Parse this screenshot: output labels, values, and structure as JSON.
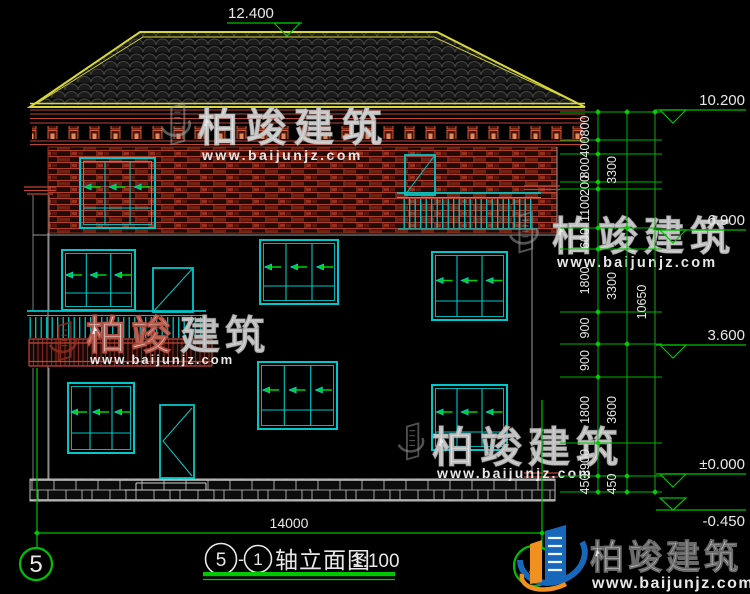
{
  "drawing": {
    "elevations": {
      "ridge": "12.400",
      "eave": "10.200",
      "floor3": "6.900",
      "floor2": "3.600",
      "ground": "±0.000",
      "base": "-0.450"
    },
    "dimensions": {
      "right_inner": [
        "800",
        "400",
        "800",
        "200",
        "1100",
        "600",
        "1800",
        "900",
        "900",
        "1800",
        "900",
        "450"
      ],
      "right_middle": [
        "3300",
        "3300",
        "3600",
        "450"
      ],
      "right_total": "10650",
      "bottom_width": "14000"
    },
    "title": {
      "axis_start": "5",
      "separator": "-",
      "axis_end": "1",
      "name": "轴立面图",
      "scale": "1:100"
    },
    "axes": {
      "left_bubble": "5",
      "right_bubble": "1"
    }
  },
  "watermark": {
    "brand": "柏竣建筑",
    "brand_left": "柏竣",
    "brand_right": "建筑",
    "url": "www.baijunjz.com"
  },
  "logo": {
    "brand": "柏竣建筑",
    "url": "www.baijunjz.com"
  },
  "colors": {
    "dim_green": "#00c000",
    "window_cyan": "#00c8c8",
    "roof_yellow": "#d8d83a",
    "brick_red": "#b03a28",
    "cornice_red": "#c04534",
    "text_white": "#e8e8e8"
  }
}
